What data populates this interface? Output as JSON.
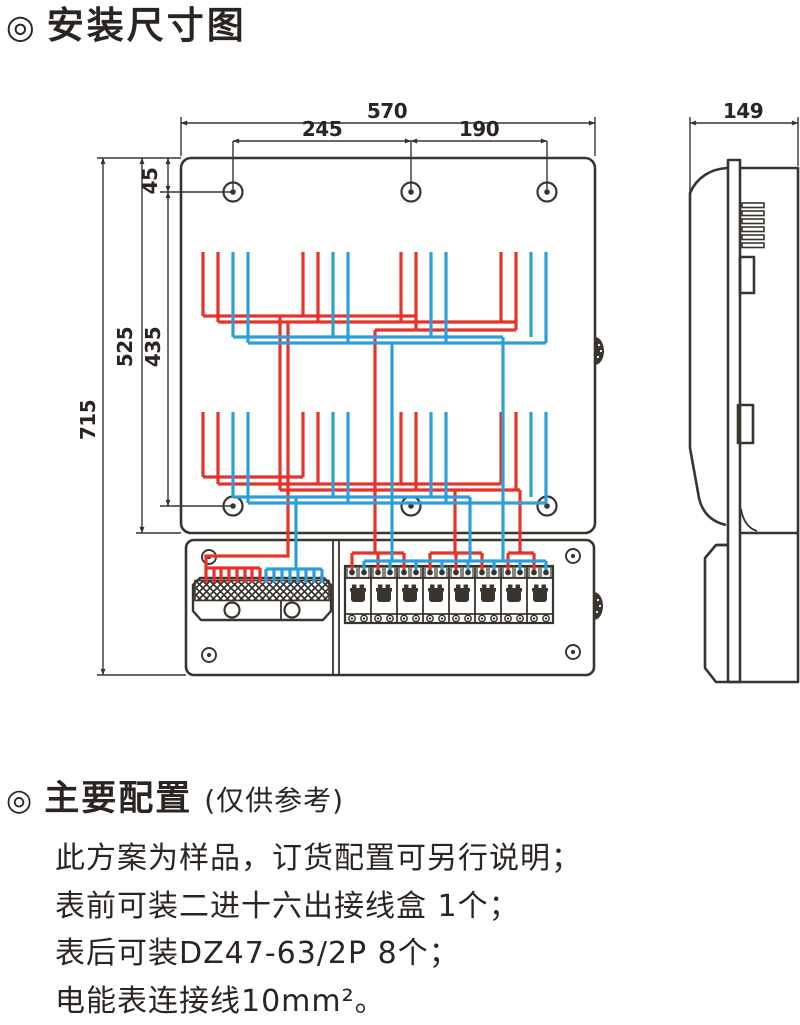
{
  "header": {
    "bullet": "◎",
    "title": "安装尺寸图"
  },
  "front_view": {
    "description": "meter box front view with red and blue wiring, 6 mounting holes, terminal block and 8 circuit breakers",
    "dims": {
      "w570": "570",
      "w245": "245",
      "w190": "190",
      "h45": "45",
      "h525": "525",
      "h435": "435",
      "h715": "715"
    }
  },
  "side_view": {
    "description": "meter box side profile with louvers and clips",
    "dims": {
      "d149": "149"
    }
  },
  "colors": {
    "line": "#3a342f",
    "wire_red": "#e5332a",
    "wire_blue": "#2c9fd9",
    "text": "#2b2522"
  },
  "config": {
    "bullet": "◎",
    "heading": "主要配置",
    "heading_note": "(仅供参考)",
    "lines": [
      "此方案为样品，订货配置可另行说明；",
      "表前可装二进十六出接线盒 1个；",
      "表后可装DZ47-63/2P  8个；",
      "电能表连接线10mm²。"
    ]
  }
}
